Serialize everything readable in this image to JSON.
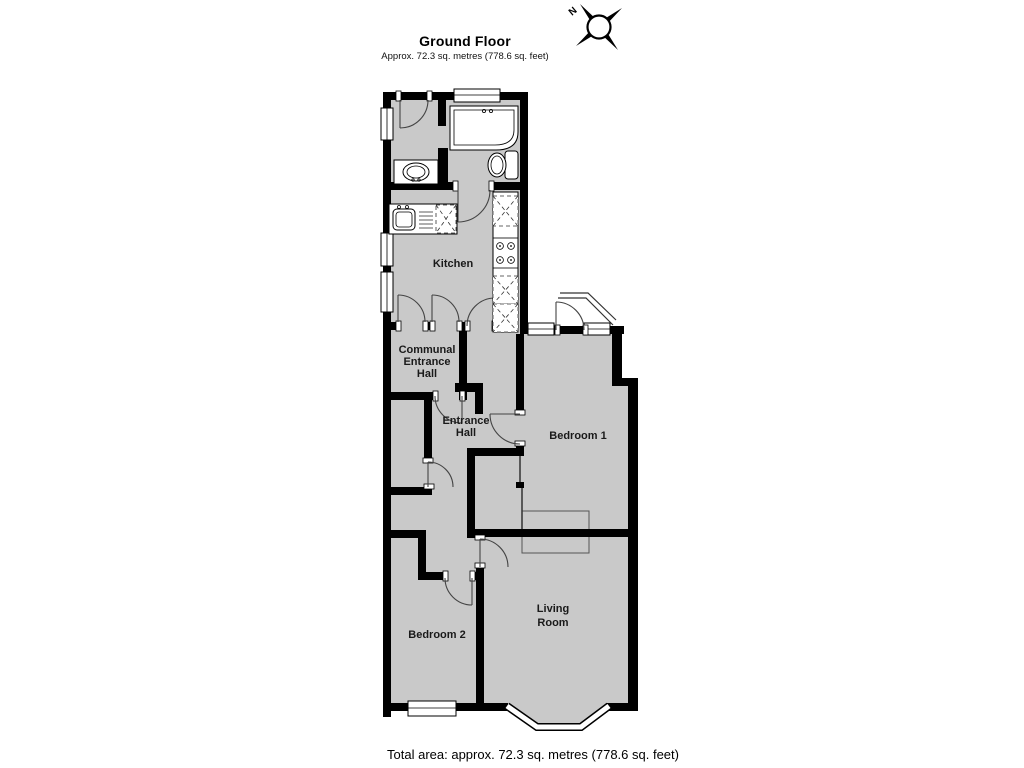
{
  "header": {
    "title": "Ground Floor",
    "subtitle": "Approx. 72.3 sq. metres (778.6 sq. feet)"
  },
  "compass": {
    "north_label": "N"
  },
  "rooms": {
    "kitchen": {
      "label": "Kitchen"
    },
    "communal_entrance_hall": {
      "line1": "Communal",
      "line2": "Entrance",
      "line3": "Hall"
    },
    "entrance_hall": {
      "line1": "Entrance",
      "line2": "Hall"
    },
    "bedroom1": {
      "label": "Bedroom 1"
    },
    "bedroom2": {
      "label": "Bedroom 2"
    },
    "living_room": {
      "line1": "Living",
      "line2": "Room"
    }
  },
  "footer": {
    "total_area": "Total area: approx. 72.3 sq. metres (778.6 sq. feet)"
  },
  "colors": {
    "wall": "#000000",
    "floor": "#c9c9c9",
    "fixture": "#ffffff"
  }
}
